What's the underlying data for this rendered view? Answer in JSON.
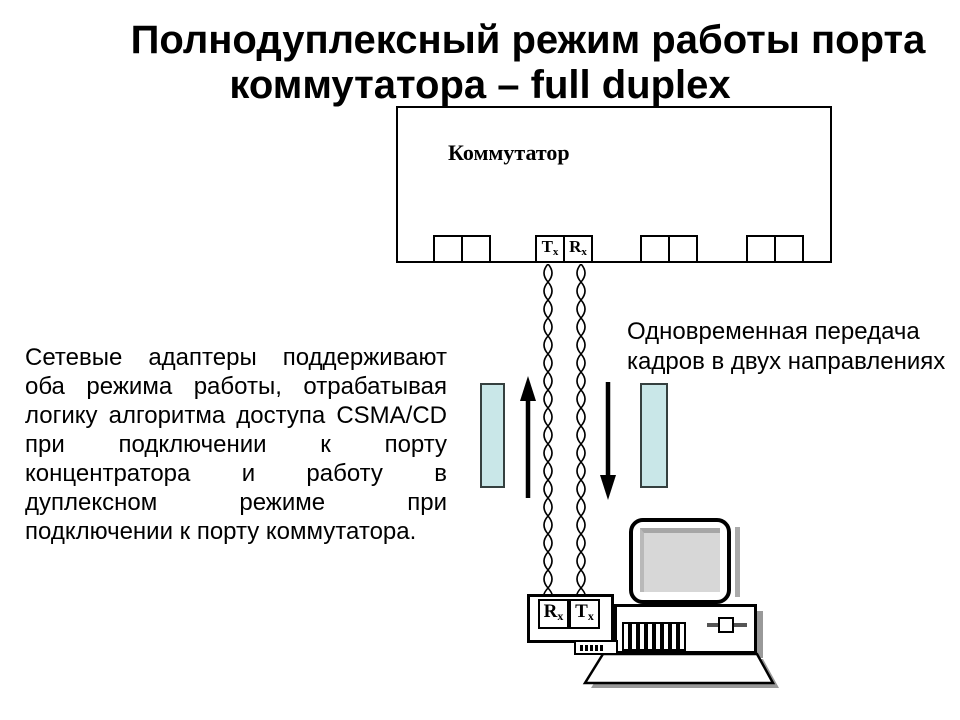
{
  "title": {
    "line1": "Полнодуплексный режим работы порта",
    "line2": "коммутатора – full duplex"
  },
  "switch": {
    "label": "Коммутатор",
    "tx": {
      "main": "T",
      "sub": "x"
    },
    "rx": {
      "main": "R",
      "sub": "x"
    }
  },
  "left_paragraph_lines": [
    "Сетевые адаптеры поддерживают",
    "оба режима работы, отрабатывая",
    "логику алгоритма доступа CSMA/CD",
    "при подключении к порту",
    "концентратора и работу в",
    "дуплексном режиме при",
    "подключении к порту коммутатора."
  ],
  "right_caption_lines": [
    "Одновременная передача",
    "кадров в двух направлениях"
  ],
  "adapter": {
    "rx": {
      "main": "R",
      "sub": "x"
    },
    "tx": {
      "main": "T",
      "sub": "x"
    }
  },
  "icons": {
    "up_arrow": "up-arrow-icon",
    "down_arrow": "down-arrow-icon",
    "twisted_pair": "twisted-pair-cable-icon",
    "monitor": "monitor-icon",
    "system_unit": "system-unit-icon",
    "keyboard": "keyboard-icon"
  },
  "colors": {
    "highlight_fill": "#c9e7e8",
    "highlight_border": "#35403f",
    "shadow_gray": "#999999",
    "screen_fill": "#d7d7d7",
    "screen_edge": "#a6a6a6",
    "line": "#000000"
  }
}
